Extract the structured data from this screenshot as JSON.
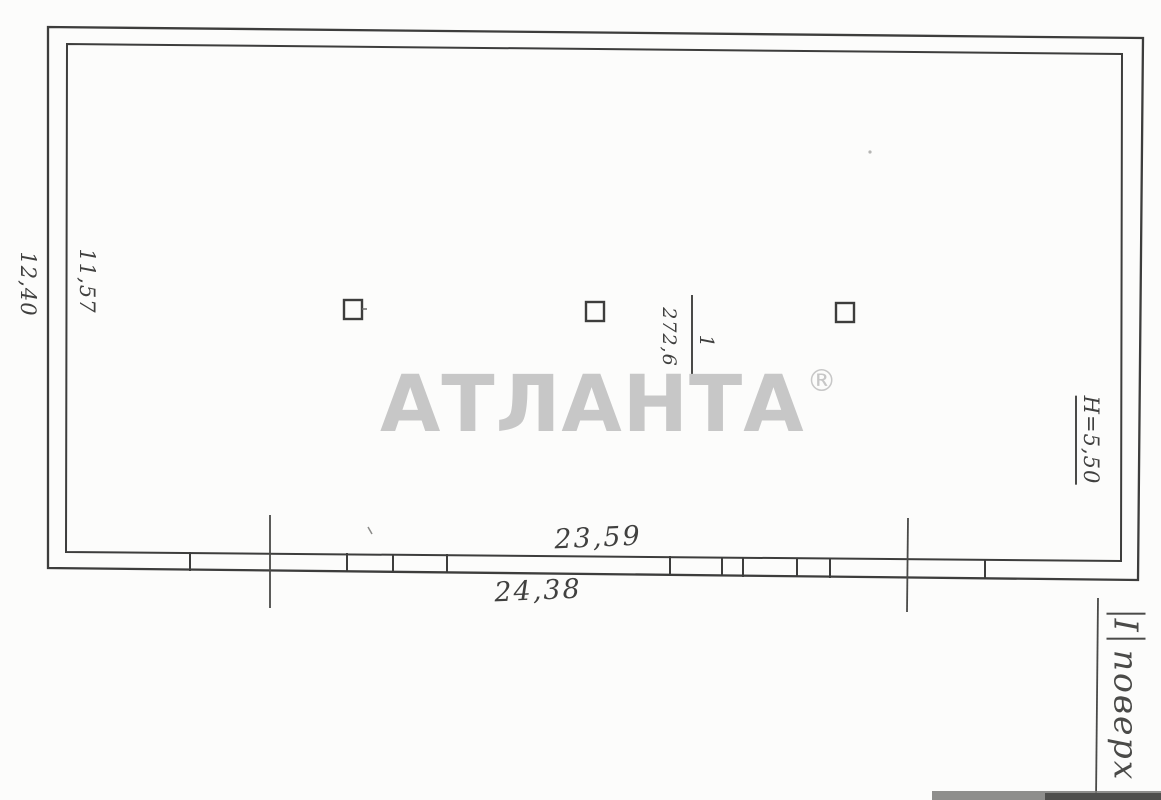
{
  "watermark": {
    "text": "АТЛАНТА",
    "registered": "®"
  },
  "annotations": {
    "dim_left_outer": "12,40",
    "dim_left_inner": "11,57",
    "dim_bottom_inner": "23,59",
    "dim_bottom_outer": "24,38",
    "ceiling_height": "H=5,50",
    "room_number": "1",
    "room_area": "272,6",
    "floor_numeral": "І",
    "floor_word": "поверх"
  },
  "colors": {
    "ink": "#3d3d3c",
    "watermark_gray": "#c7c7c7",
    "paper": "#fcfcfb"
  }
}
